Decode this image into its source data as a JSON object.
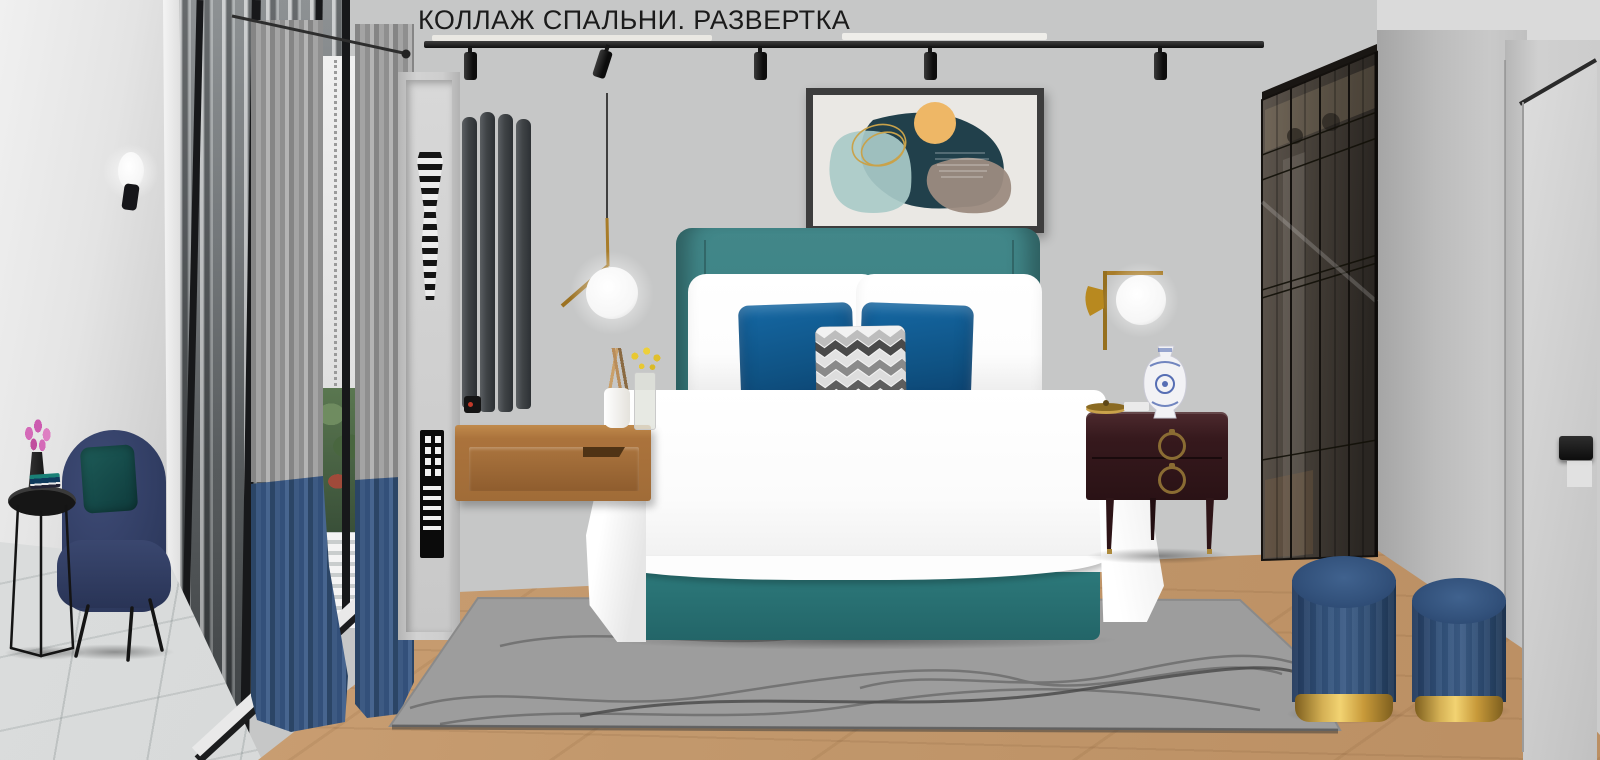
{
  "title": "КОЛЛАЖ СПАЛЬНИ. РАЗВЕРТКА",
  "scene": {
    "type": "interior-design-collage",
    "room": "bedroom elevation moodboard",
    "objects": [
      {
        "name": "track-lighting",
        "color": "#1a1a1a",
        "spots": 5
      },
      {
        "name": "pendant-lamp-brass-globe",
        "color": "#a87c28",
        "globe_color": "#ffffff"
      },
      {
        "name": "wall-sconce-left",
        "colors": [
          "#ffffff",
          "#17171a"
        ]
      },
      {
        "name": "wall-sconce-right-brass",
        "colors": [
          "#a87c28",
          "#ffffff"
        ]
      },
      {
        "name": "panoramic-window-city-view",
        "frame_color": "#17181a"
      },
      {
        "name": "color-block-curtains",
        "colors": [
          "#9a9a9a",
          "#3b5880"
        ]
      },
      {
        "name": "wall-niche-shelf",
        "color": "#cecece",
        "decor": [
          "striped-vase-black-white",
          "skyscraper-sculpture-black"
        ]
      },
      {
        "name": "vertical-radiator",
        "color": "#3a3e41",
        "slats": 4
      },
      {
        "name": "abstract-artwork",
        "frame_color": "#3d3d3d",
        "shape_colors": [
          "#21404b",
          "#a9cac8",
          "#9c8b7f",
          "#eeb766",
          "#c9a24a"
        ]
      },
      {
        "name": "upholstered-bed",
        "headboard_color": "#3a8183",
        "base_color": "#2f7f80",
        "bedding_color": "#ffffff"
      },
      {
        "name": "velvet-pillows-blue",
        "color": "#0f5283",
        "count": 2
      },
      {
        "name": "chevron-pillow",
        "colors": [
          "#f2f2f2",
          "#9b9b9b",
          "#3c3c3c"
        ]
      },
      {
        "name": "floating-nightstand-wood",
        "color": "#a96f3a"
      },
      {
        "name": "classic-nightstand-espresso",
        "color": "#33191d",
        "pull_color": "#8a6c33"
      },
      {
        "name": "porcelain-vase-blue-white",
        "colors": [
          "#f2f2f5",
          "#3b57a8"
        ]
      },
      {
        "name": "wardrobe-smoked-glass",
        "color": "#3f3933"
      },
      {
        "name": "flush-door-gray",
        "color": "#d0d0d0",
        "handle_color": "#1c1c1c"
      },
      {
        "name": "velvet-poufs-navy-gold",
        "body_color": "#2c4a70",
        "base_color": "#c89a3a",
        "count": 2
      },
      {
        "name": "shaggy-rug-gray",
        "color": "#9d9d9d"
      },
      {
        "name": "armchair-navy",
        "color": "#2f3b60",
        "pillow_color": "#154a49"
      },
      {
        "name": "side-table-black-round",
        "color": "#161616"
      },
      {
        "name": "pink-tulips",
        "color": "#d46ab8"
      },
      {
        "name": "floor-wood-planks",
        "color": "#c2986c"
      },
      {
        "name": "floor-tile-gray",
        "color": "#d8dada"
      }
    ]
  },
  "palette": {
    "wall": "#c6c7c7",
    "wall_left": "#e8e8e8",
    "accent_teal": "#3a8183",
    "pillow_blue": "#0f5283",
    "curtain_gray": "#9a9a9a",
    "curtain_navy": "#3b5880",
    "brass": "#a87c28",
    "pouf_gold": "#c89a3a",
    "dark_track": "#1a1a1a"
  }
}
